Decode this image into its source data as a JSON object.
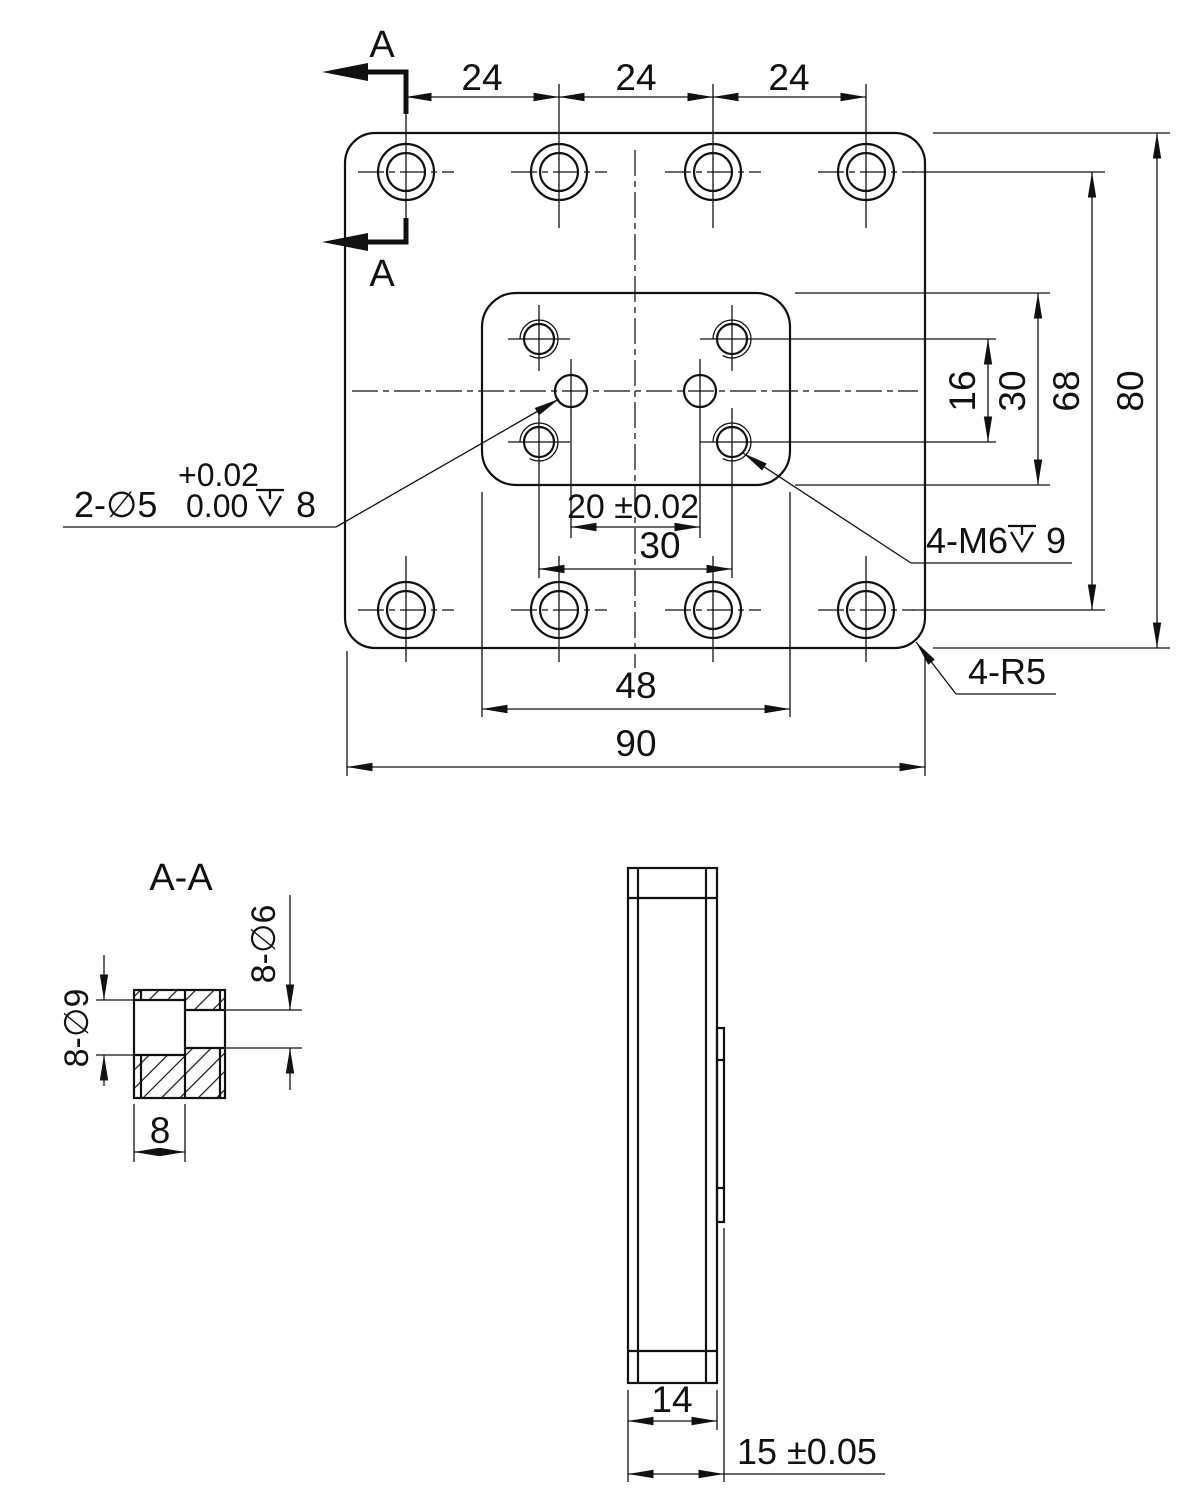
{
  "page": {
    "background": "#ffffff",
    "line_color": "#111111"
  },
  "top_view": {
    "section_label_top": "A",
    "section_label_bottom": "A",
    "dim_top_1": "24",
    "dim_top_2": "24",
    "dim_top_3": "24",
    "dim_right_pitch_v": "16",
    "dim_right_boss_h": "30",
    "dim_right_holes_v": "68",
    "dim_right_height": "80",
    "dim_dowel_pitch": "20 ±0.02",
    "dim_tap_pitch": "30",
    "dim_boss_width": "48",
    "dim_width": "90",
    "callout_dowel_prefix": "2-∅5",
    "callout_dowel_tol_upper": "+0.02",
    "callout_dowel_tol_lower": "0.00",
    "callout_dowel_depth": "8",
    "callout_tap_prefix": "4-M6",
    "callout_tap_depth": "9",
    "callout_corner_radius": "4-R5"
  },
  "section_view": {
    "title": "A-A",
    "dim_counterbore": "8-∅9",
    "dim_through_hole": "8-∅6",
    "dim_counterbore_depth": "8"
  },
  "side_view": {
    "dim_body_thickness": "14",
    "dim_total_thickness": "15 ±0.05"
  }
}
